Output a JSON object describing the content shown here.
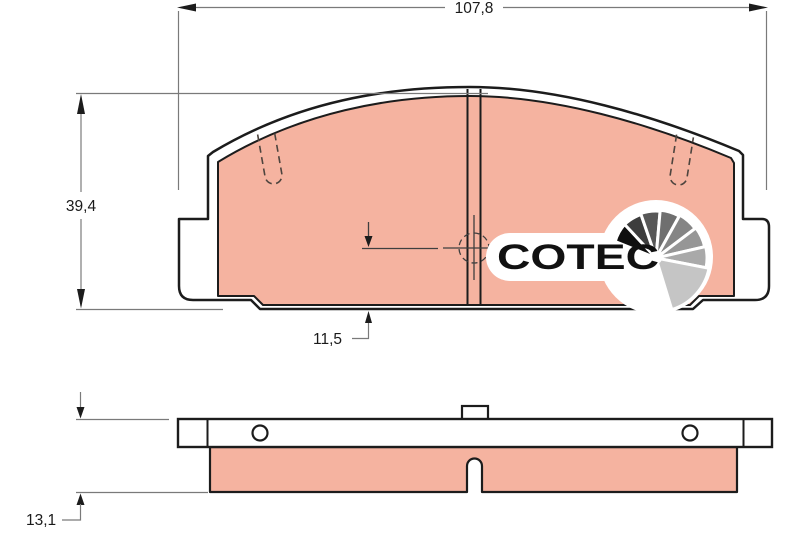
{
  "dimensions": {
    "overall_width": {
      "label": "107,8",
      "value_mm": 107.8
    },
    "pad_height": {
      "label": "39,4",
      "value_mm": 39.4
    },
    "center_to_bottom": {
      "label": "11,5",
      "value_mm": 11.5
    },
    "total_thickness": {
      "label": "13,1",
      "value_mm": 13.1
    }
  },
  "logo": {
    "text": "COTEC",
    "fan_shades": [
      "#0f0f0f",
      "#3d3d3d",
      "#575757",
      "#6f6f6f",
      "#858585",
      "#969696",
      "#a9a9a9",
      "#c5c5c5"
    ]
  },
  "colors": {
    "friction_material": "#f5b3a0",
    "part_outline": "#1c1c1c",
    "dimension_line": "#7a7a7a",
    "centerline": "#3f3f3f",
    "wear_slot_dash": "#4d443e",
    "label_text": "#1a1a1a",
    "background": "#ffffff"
  }
}
